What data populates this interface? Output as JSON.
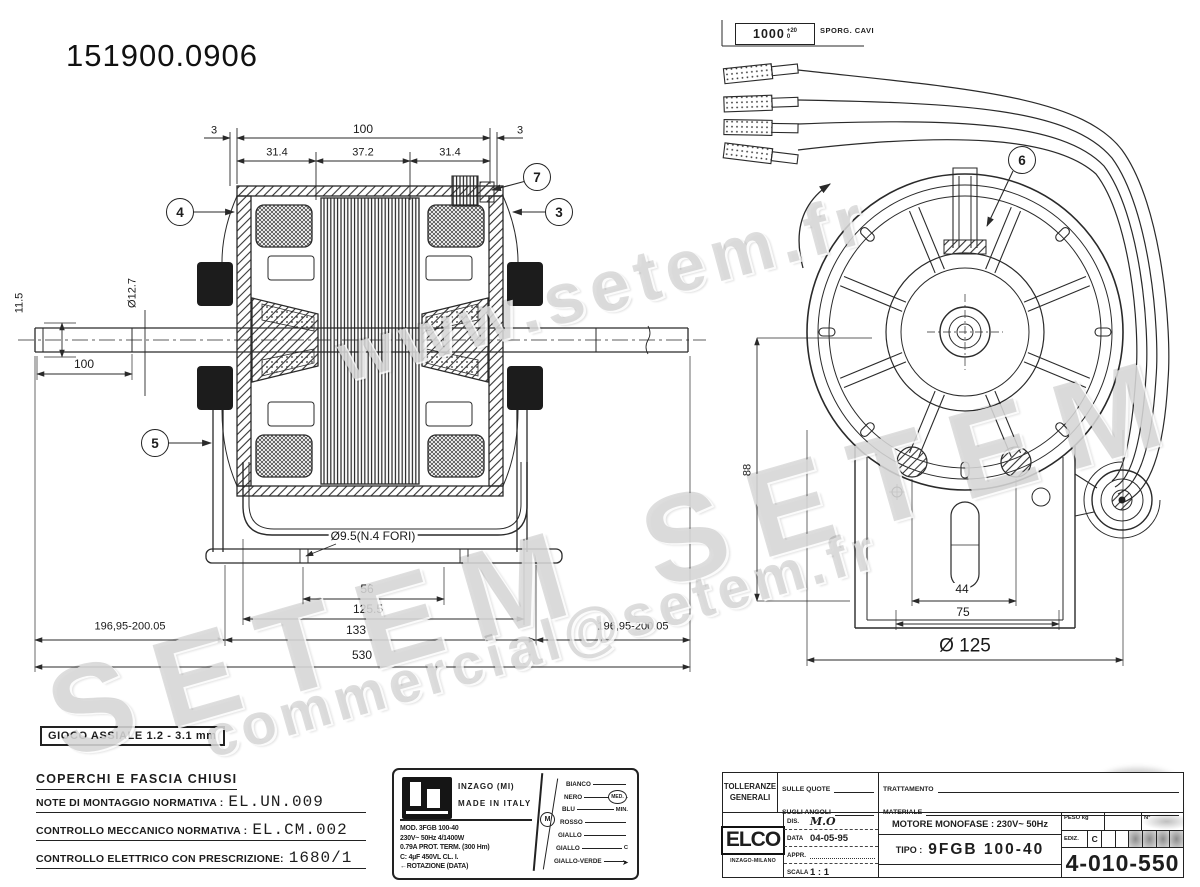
{
  "header": {
    "part_number": "151900.0906"
  },
  "watermark": {
    "top": "www.setem.fr",
    "middle": "SETEM  SETEM",
    "bottom": "commercial@setem.fr"
  },
  "icons": {
    "wire_end_arrow": "➤"
  },
  "left_view": {
    "balloons": {
      "b3": "3",
      "b4": "4",
      "b5": "5",
      "b7": "7"
    },
    "dims": {
      "cover_left": "3",
      "stator_length": "100",
      "cover_right": "3",
      "seg_left": "31.4",
      "seg_mid": "37.2",
      "seg_right": "31.4",
      "shaft_flat": "11.5",
      "shaft_dia": "Ø12.7",
      "shaft_seat": "100",
      "foot_holes": "Ø9.5(N.4 FORI)",
      "hole_span": "56",
      "bracket_inner": "125.5",
      "bracket_width": "133",
      "shaft_ext_left": "196,95-200.05",
      "shaft_ext_right": "196,95-200.05",
      "overall": "530"
    }
  },
  "right_view": {
    "balloons": {
      "b6": "6"
    },
    "cable_note": {
      "length": "1000",
      "tol_plus": "+20",
      "tol_minus": "0",
      "label": "SPORG. CAVI"
    },
    "dims": {
      "center_height": "88",
      "slot_span": "44",
      "base_span": "75",
      "diameter": "Ø 125"
    }
  },
  "notes": {
    "axial_play": "GIOCO ASSIALE 1.2 - 3.1 mm",
    "title": "COPERCHI E FASCIA CHIUSI",
    "row1_label": "NOTE DI MONTAGGIO NORMATIVA :",
    "row1_value": "EL.UN.009",
    "row2_label": "CONTROLLO MECCANICO NORMATIVA :",
    "row2_value": "EL.CM.002",
    "row3_label": "CONTROLLO ELETTRICO CON PRESCRIZIONE:",
    "row3_value": "1680/1"
  },
  "nameplate": {
    "maker_city": "INZAGO (MI)",
    "made_in": "MADE IN ITALY",
    "line1": "MOD. 3FGB 100-40",
    "line2": "230V~ 50Hz 4/1400W",
    "line3": "0.79A PROT. TERM. (300 Hm)",
    "line4": "C: 4µF 450VL CL. I.",
    "line5": "←ROTAZIONE  (DATA)",
    "motor_symbol": "M",
    "wire_mid_label": "MED.",
    "wires": [
      {
        "color": "BIANCO",
        "label": ""
      },
      {
        "color": "NERO",
        "label": "MAX."
      },
      {
        "color": "BLU",
        "label": "MIN."
      },
      {
        "color": "ROSSO",
        "label": ""
      },
      {
        "color": "GIALLO",
        "label": ""
      },
      {
        "color": "GIALLO",
        "label": "C"
      },
      {
        "color": "GIALLO-VERDE",
        "label": ""
      }
    ]
  },
  "title_block": {
    "tolerances_line1": "TOLLERANZE",
    "tolerances_line2": "GENERALI",
    "on_dims": "SULLE QUOTE",
    "on_angles": "SUGLI ANGOLI",
    "treatment": "TRATTAMENTO",
    "material": "MATERIALE",
    "company": "ELCO",
    "company_city": "INZAGO-MILANO",
    "dis_label": "DIS.",
    "dis_value": "M.O",
    "data_label": "DATA",
    "data_value": "04-05-95",
    "appr_label": "APPR.",
    "scala_label": "SCALA",
    "scala_value": "1 : 1",
    "motor_desc": "MOTORE MONOFASE : 230V~  50Hz",
    "tipo_label": "TIPO :",
    "tipo_value": "9FGB 100-40",
    "peso_label": "PESO kg",
    "n_label": "N°",
    "ediz_label": "EDIZ.",
    "ediz_value": "C",
    "drawing_number": "4-010-550"
  }
}
